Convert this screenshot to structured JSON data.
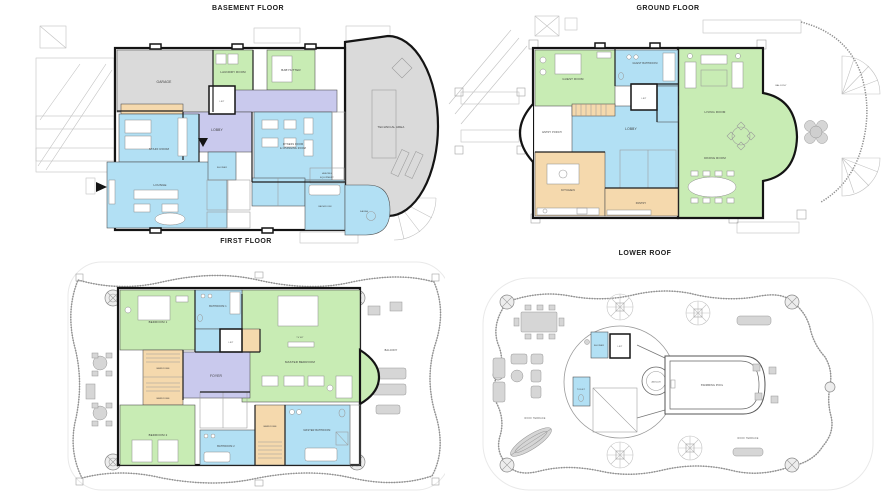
{
  "page": {
    "background": "#ffffff",
    "width": 890,
    "height": 500
  },
  "palette": {
    "wall": "#141414",
    "green": "#c8ecb4",
    "blue": "#b2e0f4",
    "lav": "#c9c9ed",
    "tan": "#f5d9ad",
    "gray": "#dadada",
    "ext": "#c2c2c2",
    "text": "#3a3a3a"
  },
  "plans": {
    "basement": {
      "title": "BASEMENT FLOOR",
      "rooms": {
        "garage": "GARAGE",
        "laundry": "LAUNDRY ROOM",
        "babysitter": "BABYSITTER",
        "lobby": "LOBBY",
        "lift": "LIFT",
        "staff_room": "STAFF ROOM",
        "lounge": "LOUNGE",
        "fitness1": "FITNESS ROOM",
        "fitness2": "& CHANGING ROOM",
        "shower": "SHOWER",
        "bathroom": "BATHROOM",
        "sauna": "SAUNA",
        "heating1": "HEATING",
        "heating2": "EQUIPMENT",
        "technical": "TECHNICAL AREA"
      }
    },
    "ground": {
      "title": "GROUND FLOOR",
      "rooms": {
        "guest_room": "GUEST ROOM",
        "guest_bathroom": "GUEST BATHROOM",
        "lift": "LIFT",
        "lobby": "LOBBY",
        "entry_porch": "ENTRY PORCH",
        "kitchen": "KITCHEN",
        "pantry": "PANTRY",
        "living_room": "LIVING ROOM",
        "dining_room": "DINING ROOM",
        "balcony": "BALCONY"
      }
    },
    "first": {
      "title": "FIRST FLOOR",
      "rooms": {
        "bedroom1": "BEDROOM 1",
        "bathroom1": "BATHROOM 1",
        "lift": "LIFT",
        "master_bedroom": "MASTER BEDROOM",
        "tv": "TV 48\"",
        "foyer": "FOYER",
        "wardrobe_a": "WARDROBE",
        "wardrobe_b": "WARDROBE",
        "bedroom2": "BEDROOM 2",
        "bathroom2": "BATHROOM 2",
        "wardrobe_c": "WARDROBE",
        "master_bathroom": "MASTER BATHROOM",
        "balcony": "BALCONY"
      }
    },
    "roof": {
      "title": "LOWER ROOF",
      "rooms": {
        "shower": "SHOWER",
        "lift": "LIFT",
        "toilet": "TOILET",
        "jacuzzi": "JACUZZI",
        "pool": "SWIMMING POOL",
        "terrace_left": "ROOF TERRACE",
        "terrace_right": "ROOF TERRACE"
      }
    }
  }
}
